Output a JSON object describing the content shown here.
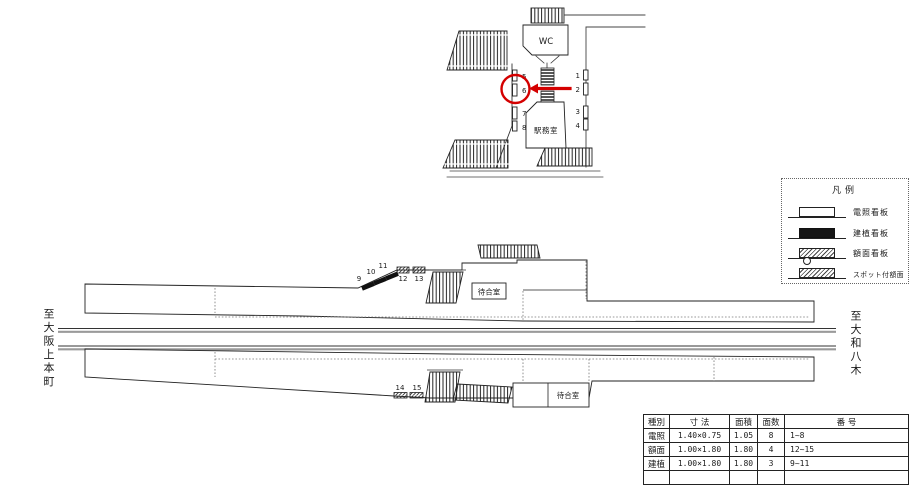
{
  "detail": {
    "wc": "WC",
    "office": "駅務室"
  },
  "map": {
    "left_dir": "至大阪上本町",
    "right_dir": "至大和八木",
    "waiting_upper": "待合室",
    "waiting_lower": "待合室"
  },
  "signs": {
    "n1": "1",
    "n2": "2",
    "n3": "3",
    "n4": "4",
    "n5": "5",
    "n6": "6",
    "n7": "7",
    "n8": "8",
    "n9": "9",
    "n10": "10",
    "n11": "11",
    "n12": "12",
    "n13": "13",
    "n14": "14",
    "n15": "15"
  },
  "legend": {
    "title": "凡例",
    "items": [
      {
        "symbol": "lit-sign",
        "label": "電照看板"
      },
      {
        "symbol": "standing-sign",
        "label": "建植看板"
      },
      {
        "symbol": "panel-sign",
        "label": "額面看板"
      },
      {
        "symbol": "spotlit-panel-sign",
        "label": "スポット付額面"
      }
    ]
  },
  "table": {
    "headers": [
      "種別",
      "寸 法",
      "面積",
      "面数",
      "番 号"
    ],
    "rows": [
      [
        "電照",
        "1.40×0.75",
        "1.05",
        "8",
        "1~8"
      ],
      [
        "額面",
        "1.00×1.80",
        "1.80",
        "4",
        "12~15"
      ],
      [
        "建植",
        "1.00×1.80",
        "1.80",
        "3",
        "9~11"
      ],
      [
        "",
        "",
        "",
        "",
        ""
      ]
    ]
  },
  "colors": {
    "highlight": "#d40000",
    "track_gray": "#9a9a9a",
    "line": "#222222"
  }
}
